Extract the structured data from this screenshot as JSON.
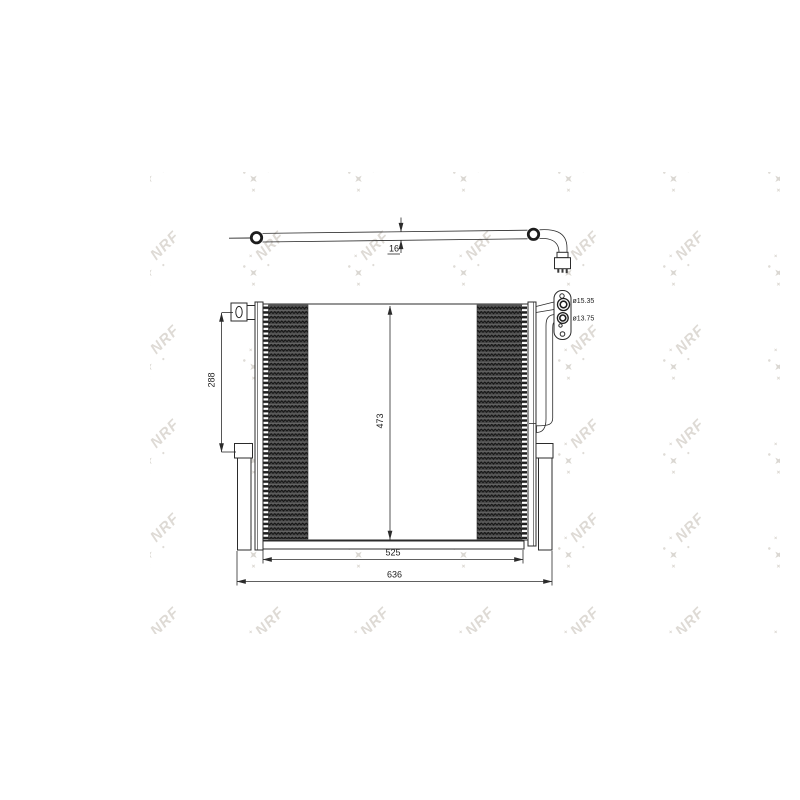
{
  "watermark": {
    "text": "NRF",
    "color": "#c9c4bb"
  },
  "drawing": {
    "part_name": "condenser-technical-drawing",
    "dimensions": {
      "tube_diameter": "16",
      "bracket_span": "288",
      "core_height": "473",
      "core_width": "525",
      "overall_width": "636"
    },
    "ports": [
      {
        "label": "ø15.35"
      },
      {
        "label": "ø13.75"
      }
    ],
    "colors": {
      "line": "#2b2b2b",
      "core_fill": "#4b4b4b"
    }
  }
}
